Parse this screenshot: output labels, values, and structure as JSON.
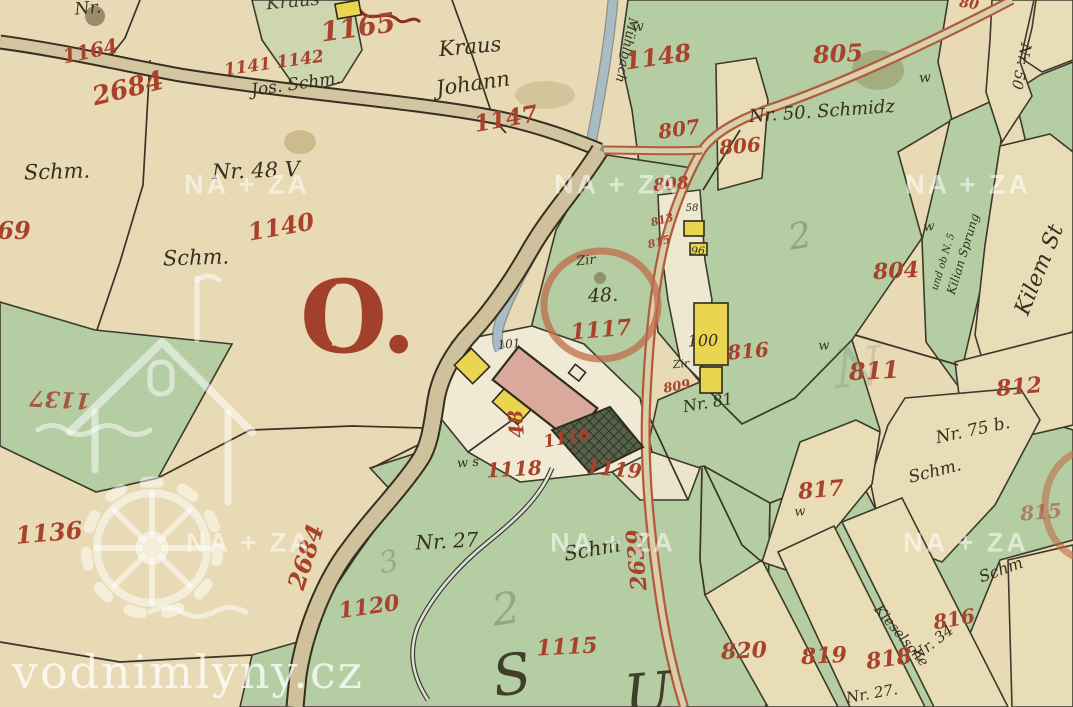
{
  "map": {
    "type": "historical-cadastral-map",
    "big_letter": "O.",
    "colors": {
      "paper_beige": "#e7dab4",
      "parcel_green": "#b5cda2",
      "pale_green": "#cdd6ae",
      "ink_black": "#35301f",
      "number_red": "#a8422c",
      "road_red_edge": "#b05c3c",
      "stream_blue": "#a8bcc6",
      "building_yellow": "#e9d54f",
      "building_pink": "#d9a99c",
      "big_letter_red": "#a2402b",
      "watermark_white": "rgba(255,255,255,0.55)"
    },
    "watermarks": {
      "site": "vodnimlyny.cz",
      "archive": "NA + ZA",
      "archive_positions": [
        [
          247,
          185
        ],
        [
          617,
          185
        ],
        [
          968,
          185
        ],
        [
          249,
          543
        ],
        [
          613,
          543
        ],
        [
          966,
          543
        ]
      ]
    },
    "labels": [
      {
        "t": "Nr.",
        "c": "ink",
        "x": 88,
        "y": 9,
        "s": 17,
        "r": -5
      },
      {
        "t": "Kraus",
        "c": "ink",
        "x": 293,
        "y": 2,
        "s": 18,
        "r": -5,
        "o": 0.9
      },
      {
        "t": "Jos. Schm.",
        "c": "ink",
        "x": 296,
        "y": 85,
        "s": 17,
        "r": -8
      },
      {
        "t": "Kraus",
        "c": "ink",
        "x": 470,
        "y": 47,
        "s": 21,
        "r": -5
      },
      {
        "t": "Johann",
        "c": "ink",
        "x": 473,
        "y": 84,
        "s": 21,
        "r": -8
      },
      {
        "t": "Schm.",
        "c": "ink",
        "x": 57,
        "y": 172,
        "s": 21,
        "r": -2
      },
      {
        "t": "Nr. 48 V",
        "c": "ink",
        "x": 256,
        "y": 171,
        "s": 21,
        "r": -2
      },
      {
        "t": "Schm.",
        "c": "ink",
        "x": 196,
        "y": 258,
        "s": 21,
        "r": -2
      },
      {
        "t": "Nr. 50. Schmidz",
        "c": "ink",
        "x": 822,
        "y": 112,
        "s": 18,
        "r": -4
      },
      {
        "t": "Nr. 50",
        "c": "ink",
        "x": 1021,
        "y": 66,
        "s": 15,
        "r": 102
      },
      {
        "t": "Mühlbach",
        "c": "ink",
        "x": 626,
        "y": 50,
        "s": 13,
        "r": 102
      },
      {
        "t": "58",
        "c": "ink",
        "x": 692,
        "y": 209,
        "s": 10,
        "r": 0
      },
      {
        "t": "96",
        "c": "ink",
        "x": 698,
        "y": 251,
        "s": 11,
        "r": 0
      },
      {
        "t": "100",
        "c": "ink",
        "x": 703,
        "y": 341,
        "s": 16,
        "r": -2
      },
      {
        "t": "Zir",
        "c": "ink",
        "x": 681,
        "y": 364,
        "s": 11,
        "r": -5
      },
      {
        "t": "Nr. 81",
        "c": "ink",
        "x": 708,
        "y": 403,
        "s": 16,
        "r": -10
      },
      {
        "t": "101",
        "c": "ink",
        "x": 509,
        "y": 344,
        "s": 12,
        "r": -5
      },
      {
        "t": "Zir",
        "c": "ink",
        "x": 586,
        "y": 261,
        "s": 13,
        "r": -5
      },
      {
        "t": "48.",
        "c": "ink",
        "x": 603,
        "y": 296,
        "s": 19,
        "r": -3
      },
      {
        "t": "Nr. 27",
        "c": "ink",
        "x": 447,
        "y": 541,
        "s": 20,
        "r": -3
      },
      {
        "t": "Schm",
        "c": "ink",
        "x": 592,
        "y": 549,
        "s": 20,
        "r": -10
      },
      {
        "t": "Nr. 75 b.",
        "c": "ink",
        "x": 973,
        "y": 431,
        "s": 17,
        "r": -12
      },
      {
        "t": "Schm.",
        "c": "ink",
        "x": 935,
        "y": 472,
        "s": 17,
        "r": -14
      },
      {
        "t": "Kilem St",
        "c": "ink",
        "x": 1040,
        "y": 270,
        "s": 22,
        "r": -68
      },
      {
        "t": "und ob N. 5",
        "c": "ink",
        "x": 944,
        "y": 262,
        "s": 10,
        "r": -73
      },
      {
        "t": "Kilian Sprung",
        "c": "ink",
        "x": 963,
        "y": 254,
        "s": 12,
        "r": -73
      },
      {
        "t": "Nr. 34",
        "c": "ink",
        "x": 933,
        "y": 643,
        "s": 15,
        "r": -38
      },
      {
        "t": "Kieselsche",
        "c": "ink",
        "x": 901,
        "y": 636,
        "s": 14,
        "r": 50
      },
      {
        "t": "Schm",
        "c": "ink",
        "x": 1001,
        "y": 570,
        "s": 16,
        "r": -20
      },
      {
        "t": "Nr. 27.",
        "c": "ink",
        "x": 872,
        "y": 694,
        "s": 15,
        "r": -10
      },
      {
        "t": "w",
        "c": "ink",
        "x": 638,
        "y": 27,
        "s": 14,
        "r": -5
      },
      {
        "t": "w",
        "c": "ink",
        "x": 925,
        "y": 78,
        "s": 14,
        "r": -5
      },
      {
        "t": "w",
        "c": "ink",
        "x": 929,
        "y": 227,
        "s": 13,
        "r": -5
      },
      {
        "t": "w",
        "c": "ink",
        "x": 824,
        "y": 346,
        "s": 13,
        "r": -5
      },
      {
        "t": "w",
        "c": "ink",
        "x": 800,
        "y": 512,
        "s": 13,
        "r": -5
      },
      {
        "t": "w s",
        "c": "ink",
        "x": 468,
        "y": 463,
        "s": 13,
        "r": -5
      },
      {
        "t": "S",
        "c": "ink",
        "x": 512,
        "y": 676,
        "s": 56,
        "r": -8,
        "o": 0.9
      },
      {
        "t": "U",
        "c": "ink",
        "x": 648,
        "y": 695,
        "s": 56,
        "r": -5,
        "o": 0.9
      },
      {
        "t": "1165",
        "c": "red",
        "x": 358,
        "y": 28,
        "s": 27,
        "r": -8
      },
      {
        "t": "1164",
        "c": "red",
        "x": 90,
        "y": 51,
        "s": 20,
        "r": -12
      },
      {
        "t": "2684",
        "c": "red",
        "x": 128,
        "y": 89,
        "s": 26,
        "r": -14
      },
      {
        "t": "1141 1142",
        "c": "red",
        "x": 274,
        "y": 64,
        "s": 17,
        "r": -8
      },
      {
        "t": "1147",
        "c": "red",
        "x": 506,
        "y": 119,
        "s": 23,
        "r": -10
      },
      {
        "t": "1148",
        "c": "red",
        "x": 658,
        "y": 57,
        "s": 24,
        "r": -8
      },
      {
        "t": "805",
        "c": "red",
        "x": 838,
        "y": 54,
        "s": 24,
        "r": -3
      },
      {
        "t": "806",
        "c": "red",
        "x": 740,
        "y": 146,
        "s": 20,
        "r": -5
      },
      {
        "t": "807",
        "c": "red",
        "x": 679,
        "y": 129,
        "s": 20,
        "r": -8
      },
      {
        "t": "808",
        "c": "red",
        "x": 671,
        "y": 185,
        "s": 17,
        "r": -5
      },
      {
        "t": "813",
        "c": "red",
        "x": 662,
        "y": 220,
        "s": 11,
        "r": -15
      },
      {
        "t": "815",
        "c": "red",
        "x": 659,
        "y": 242,
        "s": 11,
        "r": -15
      },
      {
        "t": "804",
        "c": "red",
        "x": 896,
        "y": 271,
        "s": 22,
        "r": -3
      },
      {
        "t": "811",
        "c": "red",
        "x": 874,
        "y": 371,
        "s": 24,
        "r": -3
      },
      {
        "t": "817",
        "c": "red",
        "x": 821,
        "y": 490,
        "s": 22,
        "r": -5
      },
      {
        "t": "812",
        "c": "red",
        "x": 1019,
        "y": 387,
        "s": 22,
        "r": -5
      },
      {
        "t": "815",
        "c": "red",
        "x": 1041,
        "y": 512,
        "s": 20,
        "r": -5,
        "o": 0.55
      },
      {
        "t": "816",
        "c": "red",
        "x": 748,
        "y": 351,
        "s": 20,
        "r": -5
      },
      {
        "t": "809",
        "c": "red",
        "x": 677,
        "y": 387,
        "s": 13,
        "r": -10
      },
      {
        "t": "1140",
        "c": "red",
        "x": 281,
        "y": 227,
        "s": 24,
        "r": -10
      },
      {
        "t": "1137",
        "c": "red",
        "x": 60,
        "y": 399,
        "s": 22,
        "r": 183,
        "o": 0.85
      },
      {
        "t": "1136",
        "c": "red",
        "x": 49,
        "y": 533,
        "s": 24,
        "r": -5
      },
      {
        "t": "1120",
        "c": "red",
        "x": 369,
        "y": 607,
        "s": 22,
        "r": -8
      },
      {
        "t": "1115",
        "c": "red",
        "x": 567,
        "y": 647,
        "s": 22,
        "r": -3
      },
      {
        "t": "1118",
        "c": "red",
        "x": 514,
        "y": 469,
        "s": 20,
        "r": -3
      },
      {
        "t": "1119",
        "c": "red",
        "x": 614,
        "y": 469,
        "s": 20,
        "r": 5
      },
      {
        "t": "1117",
        "c": "red",
        "x": 601,
        "y": 330,
        "s": 22,
        "r": -5
      },
      {
        "t": "48",
        "c": "red",
        "x": 516,
        "y": 424,
        "s": 20,
        "r": -95
      },
      {
        "t": "1116",
        "c": "red",
        "x": 567,
        "y": 439,
        "s": 17,
        "r": -10
      },
      {
        "t": "820",
        "c": "red",
        "x": 744,
        "y": 651,
        "s": 22,
        "r": -3
      },
      {
        "t": "819",
        "c": "red",
        "x": 824,
        "y": 656,
        "s": 22,
        "r": -3
      },
      {
        "t": "818",
        "c": "red",
        "x": 889,
        "y": 659,
        "s": 22,
        "r": -8
      },
      {
        "t": "816",
        "c": "red",
        "x": 954,
        "y": 619,
        "s": 20,
        "r": -10
      },
      {
        "t": "69",
        "c": "red",
        "x": 14,
        "y": 231,
        "s": 24,
        "r": 0
      },
      {
        "t": "2639",
        "c": "red",
        "x": 637,
        "y": 560,
        "s": 22,
        "r": -95
      },
      {
        "t": "2684",
        "c": "red",
        "x": 306,
        "y": 557,
        "s": 24,
        "r": -72
      },
      {
        "t": "80",
        "c": "red",
        "x": 969,
        "y": 4,
        "s": 14,
        "r": 8
      },
      {
        "t": "2",
        "c": "pencil",
        "x": 800,
        "y": 237,
        "s": 36,
        "r": -10,
        "o": 0.5
      },
      {
        "t": "2",
        "c": "pencil",
        "x": 506,
        "y": 610,
        "s": 44,
        "r": -8,
        "o": 0.45
      },
      {
        "t": "3",
        "c": "pencil",
        "x": 389,
        "y": 563,
        "s": 30,
        "r": -12,
        "o": 0.4
      },
      {
        "t": "N",
        "c": "pencil",
        "x": 858,
        "y": 368,
        "s": 54,
        "r": -5,
        "o": 0.22
      }
    ]
  }
}
